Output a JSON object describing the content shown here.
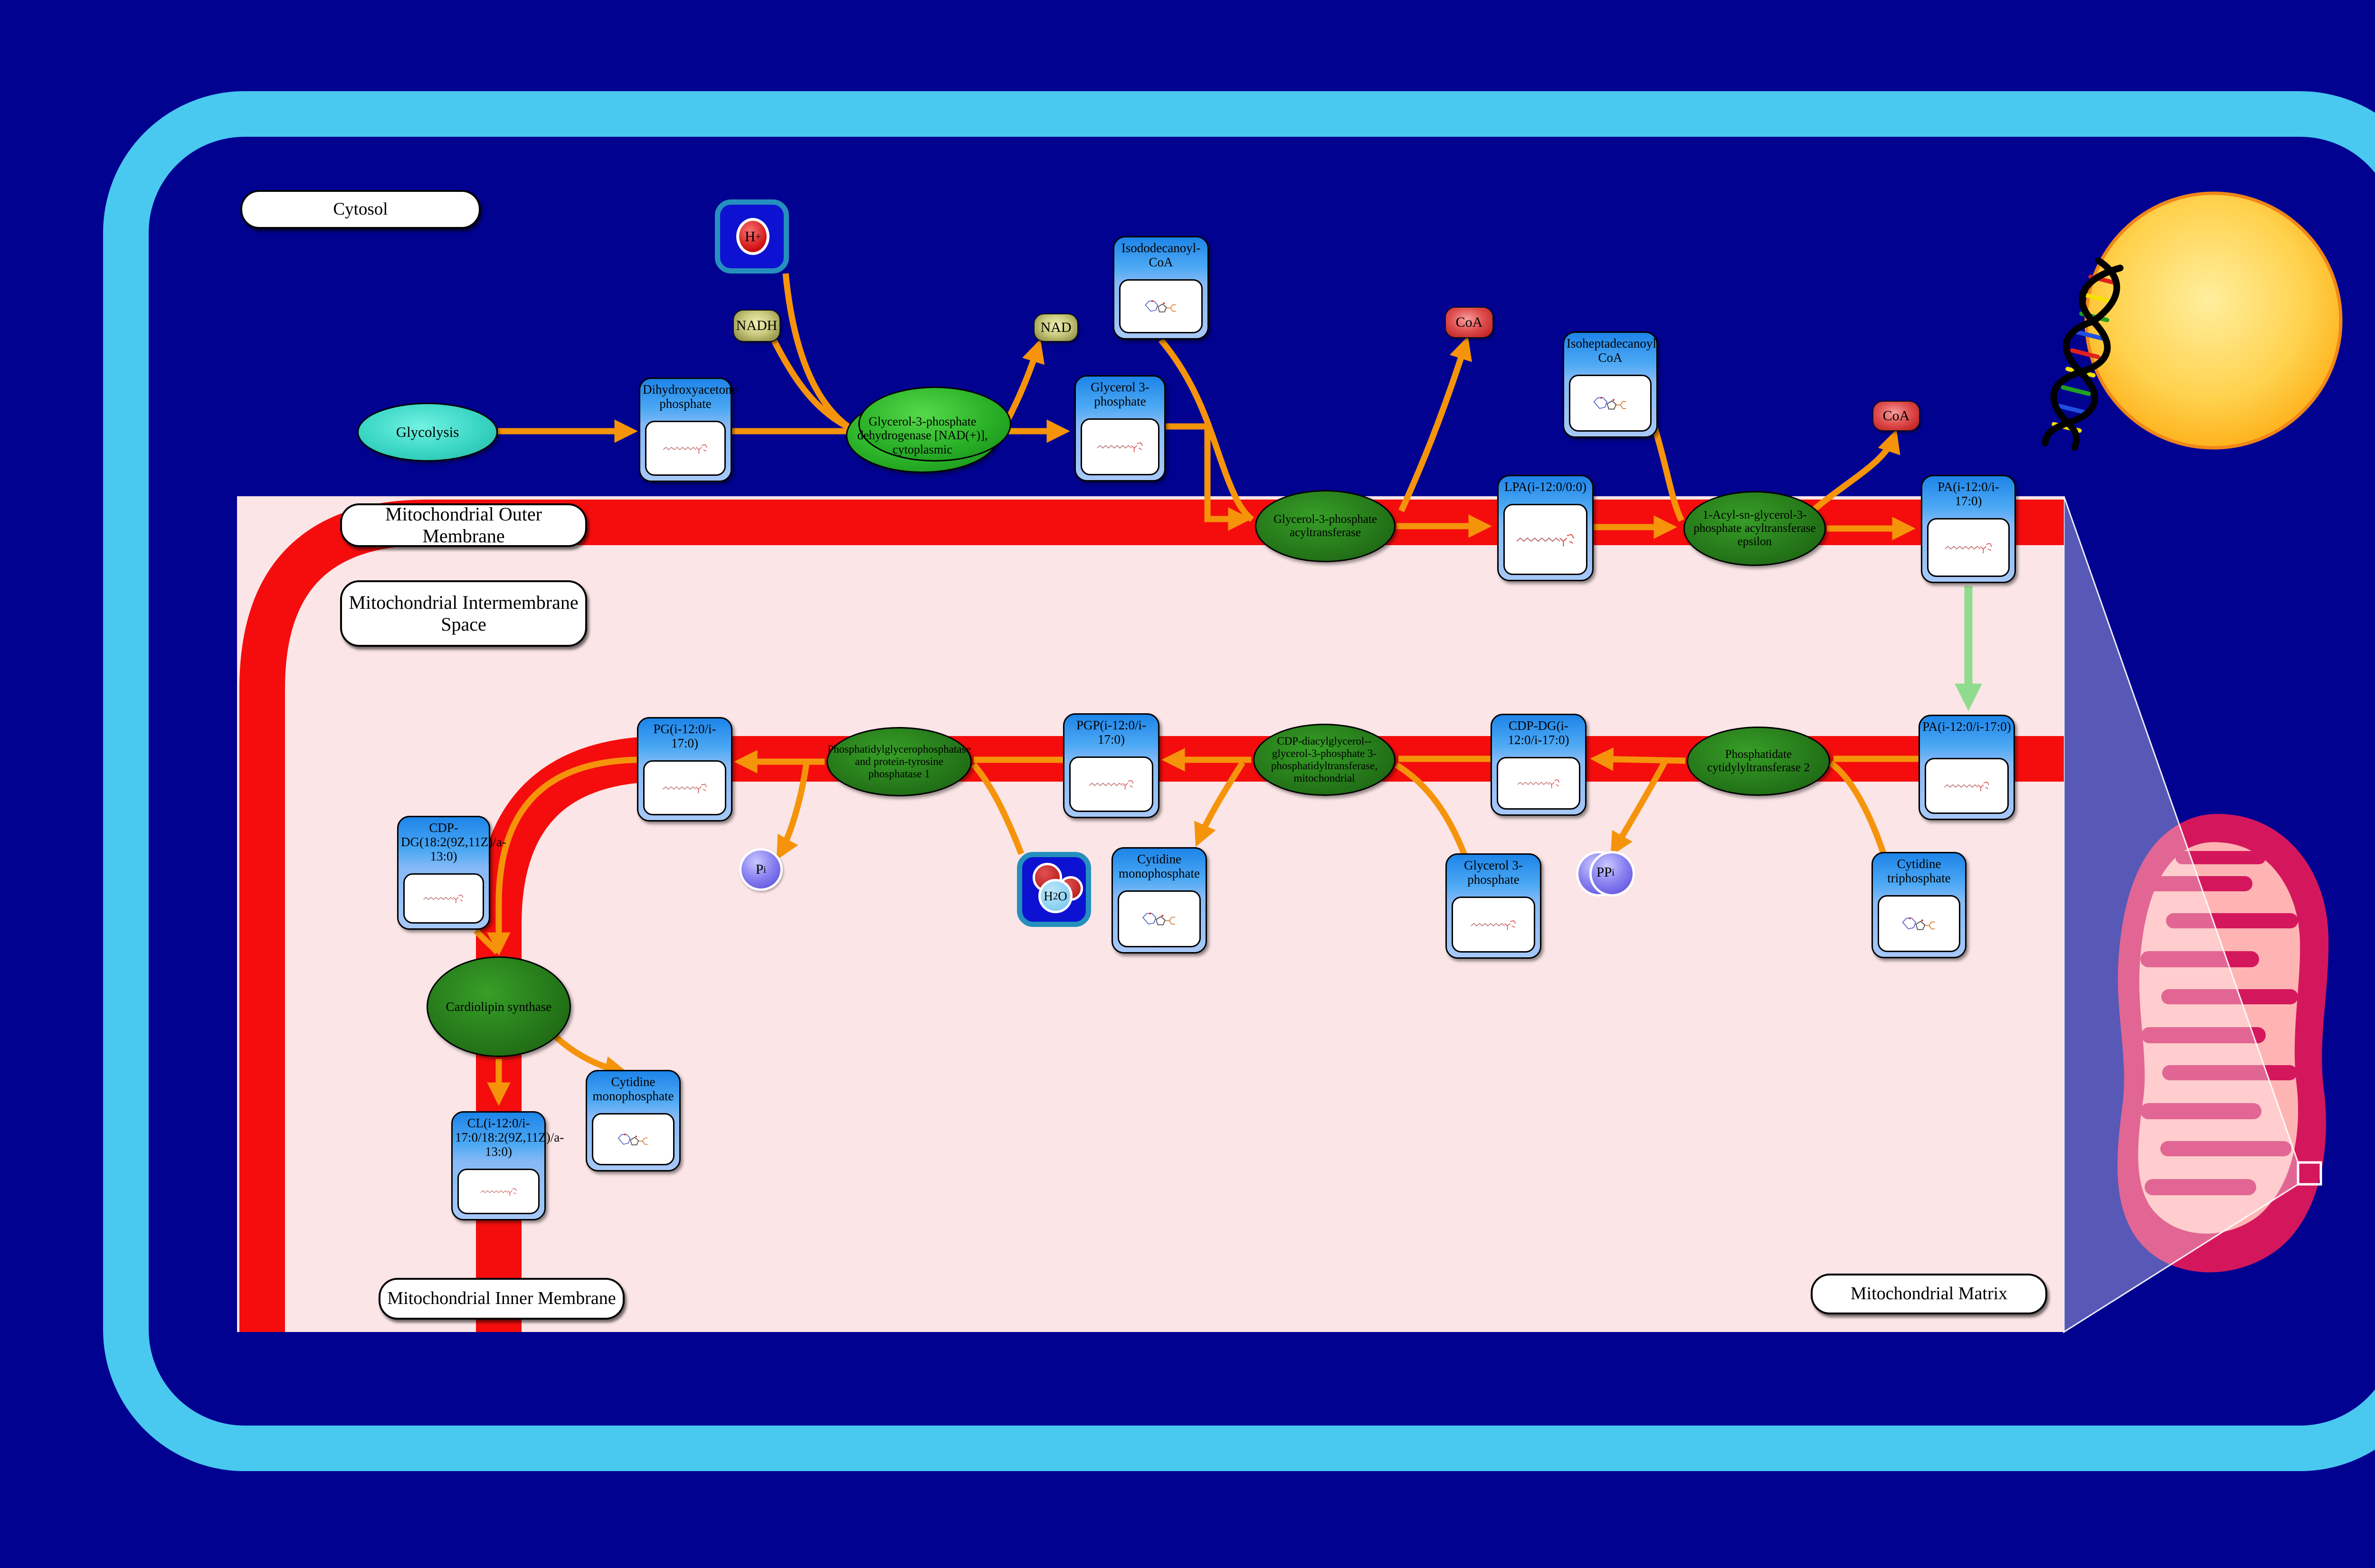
{
  "compartment_labels": {
    "cytosol": "Cytosol",
    "outer_membrane": "Mitochondrial Outer Membrane",
    "intermembrane_space": "Mitochondrial Intermembrane Space",
    "inner_membrane": "Mitochondrial Inner Membrane",
    "matrix": "Mitochondrial Matrix"
  },
  "pathway": {
    "glycolysis": "Glycolysis"
  },
  "metabolites": {
    "dhap": "Dihydroxyacetone phosphate",
    "g3p_cytosol": "Glycerol 3-phosphate",
    "isododecanoyl_coa": "Isododecanoyl-CoA",
    "lpa": "LPA(i-12:0/0:0)",
    "isoheptadecanoyl_coa": "Isoheptadecanoyl-CoA",
    "pa_outer": "PA(i-12:0/i-17:0)",
    "pa_inner": "PA(i-12:0/i-17:0)",
    "cdp_dg": "CDP-DG(i-12:0/i-17:0)",
    "ctp": "Cytidine triphosphate",
    "g3p_matrix": "Glycerol 3-phosphate",
    "pgp": "PGP(i-12:0/i-17:0)",
    "cmp_mid": "Cytidine monophosphate",
    "pg": "PG(i-12:0/i-17:0)",
    "cdp_dg_linoleoyl": "CDP-DG(18:2(9Z,11Z)/a-13:0)",
    "cardiolipin": "CL(i-12:0/i-17:0/18:2(9Z,11Z)/a-13:0)",
    "cmp_bottom": "Cytidine monophosphate"
  },
  "enzymes": {
    "gpd1": "Glycerol-3-phosphate dehydrogenase [NAD(+)], cytoplasmic",
    "gpat": "Glycerol-3-phosphate acyltransferase",
    "agpat_epsilon": "1-Acyl-sn-glycerol-3-phosphate acyltransferase epsilon",
    "cds2": "Phosphatidate cytidylyltransferase 2",
    "pgs1": "CDP-diacylglycerol--glycerol-3-phosphate 3-phosphatidyltransferase, mitochondrial",
    "ptpmt1": "Phosphatidylglycerophosphatase and protein-tyrosine phosphatase 1",
    "cls": "Cardiolipin synthase"
  },
  "small_molecules": {
    "nadh": "NADH",
    "nad": "NAD",
    "coa_1": "CoA",
    "coa_2": "CoA",
    "h_base": "H",
    "h_sup": "+",
    "h2o_h": "H",
    "h2o_sub": "2",
    "h2o_o": "O",
    "pi_base": "P",
    "pi_sub": "i",
    "ppi_base": "PP",
    "ppi_sub": "i"
  },
  "colors": {
    "background": "#020291",
    "cell_border": "#49c8f0",
    "membrane_red": "#f50d0d",
    "mito_interior_pink": "#fbe5e7",
    "arrow_orange": "#f5940a",
    "transport_green": "#8fdc8f",
    "metabolite_header_blue": "#2d9bf2",
    "metabolite_body_blue": "#a6c8f8",
    "enzyme_green": "#2e8c1c",
    "pathway_cyan": "#3ed9c8",
    "nadh_olive": "#9a9a4a",
    "coa_red": "#c42020",
    "phosphate_purple": "#6a5ae0",
    "nucleus_yellow": "#ffc93e",
    "mitochondrion_crimson": "#d4175c"
  }
}
